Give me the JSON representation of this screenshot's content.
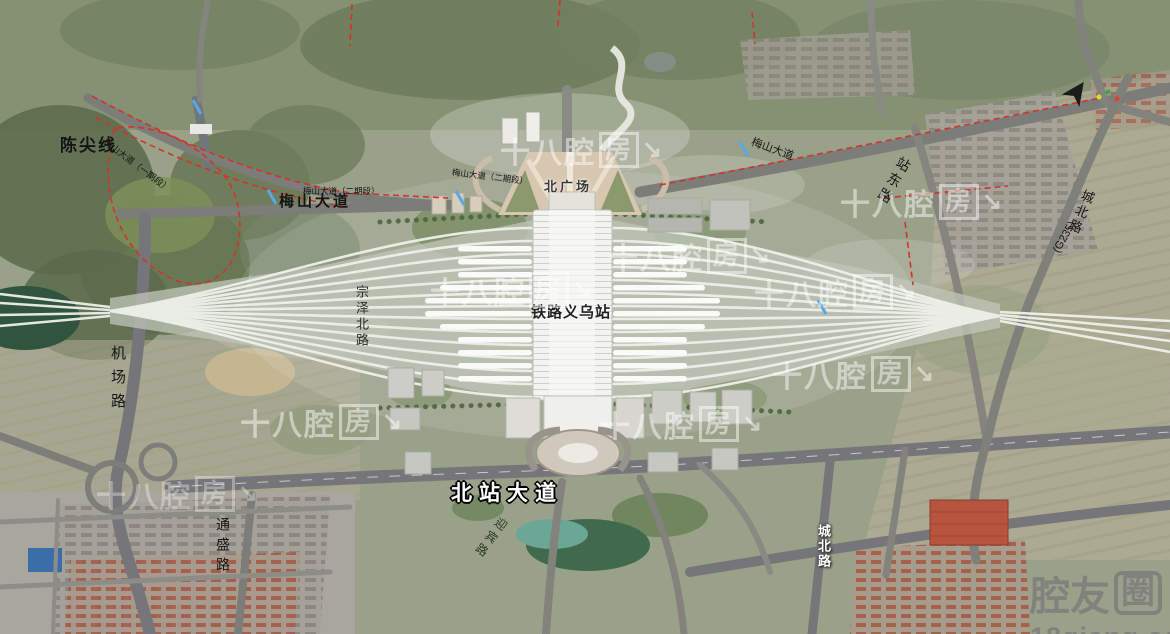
{
  "labels": {
    "chenjian_line": "陈尖线",
    "meishan_avenue_phase1": "梅山大道（一期段）",
    "meishan_avenue": "梅山大道",
    "meishan_phase2_small": "梅山大道（二期段）",
    "meishan_phase2_center": "梅山大道（二期段）",
    "meishan_avenue_east": "梅山大道",
    "north_plaza": "北广场",
    "station_name": "铁路义乌站",
    "north_station_avenue": "北站大道",
    "airport_road": "机场路",
    "zongze_north_road": "宗泽北路",
    "tongsheng_road": "通盛路",
    "station_east_road": "站东路",
    "chengbei_road_north": "城北路",
    "g235_route": "(G235)",
    "chengbei_road_south": "城北路",
    "yingbin_road": "迎宾路"
  },
  "watermarks": {
    "brand": "十八腔",
    "brand_box": "房",
    "brand_arrow": "↘",
    "footer_brand": "腔友",
    "footer_box": "圈",
    "footer_site": "18qiang.com"
  },
  "icons": {
    "compass_north_arrow": "➤"
  },
  "colors": {
    "forest": "#5e6d4f",
    "field": "#b2ac97",
    "road": "#7c7c78",
    "track_line": "#eef0ea",
    "red_boundary": "#d0342c",
    "pond": "#41694d",
    "pool": "#6aa795",
    "station_roof": "#f3f3f1"
  }
}
